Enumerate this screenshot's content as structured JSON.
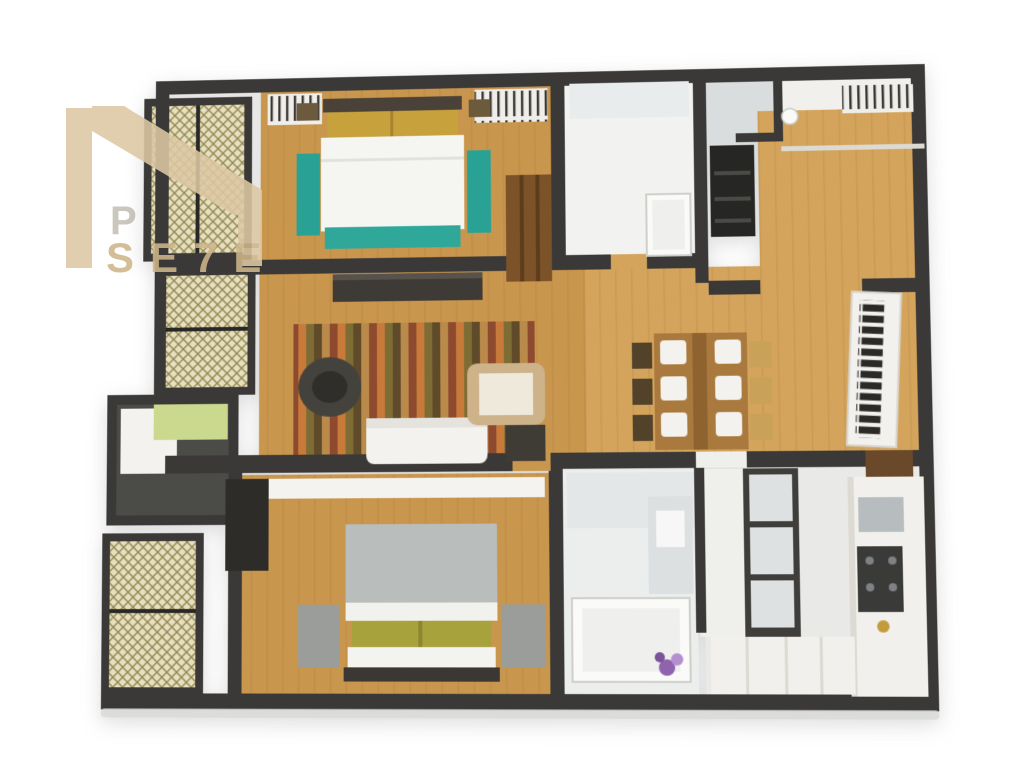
{
  "scene": {
    "description": "3D rendered floor plan of a two-bedroom apartment viewed from above",
    "background": "#ffffff"
  },
  "watermark": {
    "line1": "PO",
    "line2": "SE7E",
    "mark": "n-roofline-logo"
  },
  "palette": {
    "page_bg": "#ffffff",
    "wall": "#3a3937",
    "wall_dark": "#282725",
    "wood": "#c9964e",
    "wood_light": "#d4a45c",
    "plank_line": "#8a5c22",
    "white_room": "#f2f3f1",
    "counter": "#f1f0ec",
    "counter_edge": "#dcdad2",
    "tile": "#d9dddd",
    "bath_floor": "#eceeee",
    "tile_mid": "#e3e7e8",
    "vanity": "#dce0e1",
    "kitchen_floor": "#e9eae7",
    "corridor": "#efefec",
    "shelf_box": "#dde1e1",
    "hatch_bg": "#e8dfc2",
    "hatch_line": "#8f884e",
    "teal": "#2fa89a",
    "teal2": "#2aa195",
    "gold": "#c6a13c",
    "gold_dark": "#a8822c",
    "olive": "#a8a23c",
    "olive_dark": "#8c8630",
    "duvet_white": "#f5f5f2",
    "duvet_gray": "#b9bdbb",
    "bench_gray": "#9b9d9a",
    "headboard": "#4a4238",
    "wardrobe_brown": "#7c5228",
    "cabinet_brown": "#6a482a",
    "table_wood": "#aa793d",
    "table_runner": "#8f6330",
    "chair_dark": "#53422a",
    "chair_tan": "#c9a159",
    "sofa_white": "#f3f2ee",
    "armchair_tan": "#cdb28a",
    "armchair_cushion": "#efe9dc",
    "console_dark": "#3e3a35",
    "chair_office": "#44423d",
    "rug_a": "#8e4a2e",
    "rug_b": "#c77a3a",
    "rug_c": "#7d6d34",
    "rug_d": "#5f4a2a",
    "rug_e": "#b98a4a",
    "lime": "#cbd98f",
    "balcony_floor": "#4b4b47",
    "appliance": "#262624",
    "appliance_line": "#4a4a46",
    "cooktop": "#3a3a38",
    "burner": "#7e8284",
    "sink_gray": "#b7bdbe",
    "gold_fixture": "#c39a3c",
    "tub_white": "#fafaf9",
    "tub_inner": "#eff0ee",
    "tub_edge": "#cfcfca",
    "flower_purple": "#8f63ae",
    "flower_lilac": "#b48fd0",
    "flower_deep": "#7a5399",
    "slab_shadow": "#d9d9d7",
    "mark": "#dcc8a3",
    "text1": "#cbc7bf",
    "text2": "#cdb58a",
    "clothes_bg": "#efeeea",
    "clothes_tick": "#3a3632",
    "books_dark": "#2c2a27",
    "bookshelf_white": "#f2f1ed"
  },
  "rooms": [
    {
      "id": "bedroom-top",
      "contents": "double bed, gold pillows, teal foot runner, teal benches, brown wardrobe, closets"
    },
    {
      "id": "bathroom-top",
      "contents": "bathtub, vanity"
    },
    {
      "id": "foyer-laundry",
      "contents": "appliance stack, counters, sink, powder room"
    },
    {
      "id": "living-room",
      "contents": "striped rug, office chair, white sofa, armchair, media console"
    },
    {
      "id": "dining-room",
      "contents": "dining table, six chairs, bookshelf, cabinet"
    },
    {
      "id": "balcony",
      "contents": "lime mat, dark deck"
    },
    {
      "id": "bedroom-bottom",
      "contents": "double bed, olive pillows, gray benches, dark wardrobe, dresser"
    },
    {
      "id": "bathroom-bottom",
      "contents": "bathtub, vanity, purple flowers"
    },
    {
      "id": "kitchen",
      "contents": "cooktop, gray sink, gold fixture, counters, shelf unit"
    }
  ]
}
